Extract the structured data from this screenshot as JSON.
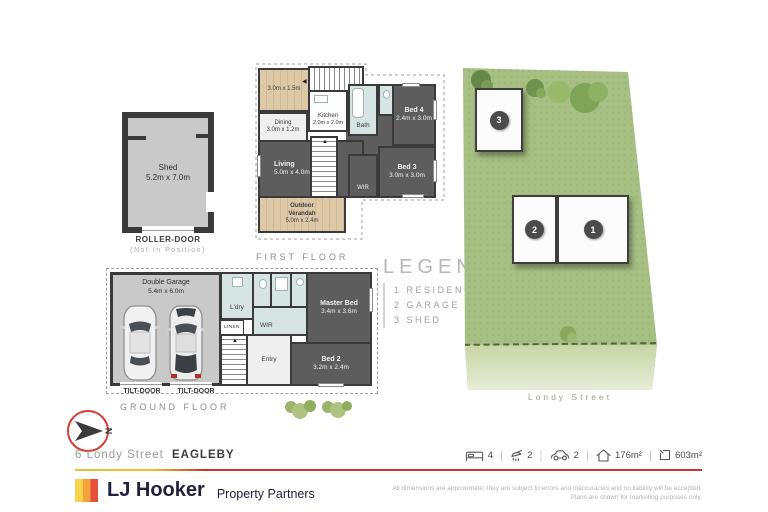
{
  "shed_plan": {
    "name": "Shed",
    "dims": "5.2m x 7.0m",
    "door": "ROLLER-DOOR",
    "door_note": "(Not In Position)"
  },
  "first_floor": {
    "title": "FIRST FLOOR",
    "deck_dims": "3.0m x 1.5m",
    "kitchen": "Kitchen",
    "kitchen_dims": "2.0m x 2.0m",
    "dining": "Dining",
    "dining_dims": "3.0m x 1.2m",
    "bath": "Bath",
    "bed4": "Bed 4",
    "bed4_dims": "2.4m x 3.0m",
    "living": "Living",
    "living_dims": "5.0m x 4.0m",
    "bed3": "Bed 3",
    "bed3_dims": "3.0m x 3.0m",
    "wir": "WIR",
    "verandah": "Outdoor Verandah",
    "verandah_dims": "5.0m x 2.4m"
  },
  "ground_floor": {
    "title": "GROUND FLOOR",
    "garage": "Double Garage",
    "garage_dims": "5.4m x 6.0m",
    "laundry": "L'dry",
    "wir": "WIR",
    "linen": "LINEN",
    "master": "Master Bed",
    "master_dims": "3.4m x 3.6m",
    "bed2": "Bed 2",
    "bed2_dims": "3.2m x 2.4m",
    "entry": "Entry",
    "tilt_left": "TILT-DOOR",
    "tilt_right": "TILT-DOOR"
  },
  "legend": {
    "title": "LEGEND",
    "items": [
      {
        "num": "1",
        "label": "RESIDENCE"
      },
      {
        "num": "2",
        "label": "GARAGE"
      },
      {
        "num": "3",
        "label": "SHED"
      }
    ]
  },
  "site_plan": {
    "street": "Londy Street",
    "marker1": "1",
    "marker2": "2",
    "marker3": "3"
  },
  "compass": {
    "north": "N"
  },
  "footer": {
    "address_street": "6 Londy Street",
    "address_suburb": "EAGLEBY",
    "stats": [
      {
        "icon": "bed-icon",
        "value": "4"
      },
      {
        "icon": "shower-icon",
        "value": "2"
      },
      {
        "icon": "car-icon",
        "value": "2"
      },
      {
        "icon": "house-area-icon",
        "value": "176m²"
      },
      {
        "icon": "land-area-icon",
        "value": "603m²"
      }
    ],
    "brand": "LJ Hooker",
    "brand_sub": "Property Partners",
    "disclaimer1": "All dimensions are approximate; they are subject to errors and inaccuracies and no liability will be accepted.",
    "disclaimer2": "Plans are shown for marketing purposes only."
  },
  "colors": {
    "accent_red": "#cf342c",
    "accent_yellow": "#eebd31",
    "brand_navy": "#22223c",
    "wall": "#3a3a3a",
    "room_dark": "#5d5d5d",
    "wet_area": "#d6e4e3",
    "deck_wood": "#dcc9a9",
    "grass": "#a6bf82",
    "street_verge": "#c7d6a5"
  }
}
